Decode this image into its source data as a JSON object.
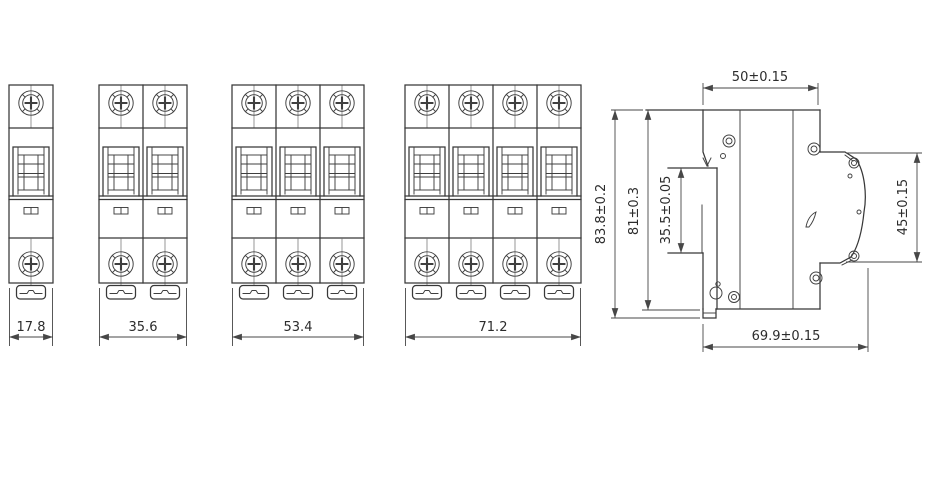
{
  "drawing": {
    "background": "#ffffff",
    "line_color": "#3a3a3a",
    "front_views": [
      {
        "poles": 1,
        "width_label": "17.8"
      },
      {
        "poles": 2,
        "width_label": "35.6"
      },
      {
        "poles": 3,
        "width_label": "53.4"
      },
      {
        "poles": 4,
        "width_label": "71.2"
      }
    ],
    "side_view": {
      "top_width_label": "50±0.15",
      "overall_height_label": "83.8±0.2",
      "housing_height_label": "81±0.3",
      "din_slot_label": "35.5±0.05",
      "front_face_label": "45±0.15",
      "bottom_depth_label": "69.9±0.15"
    }
  }
}
